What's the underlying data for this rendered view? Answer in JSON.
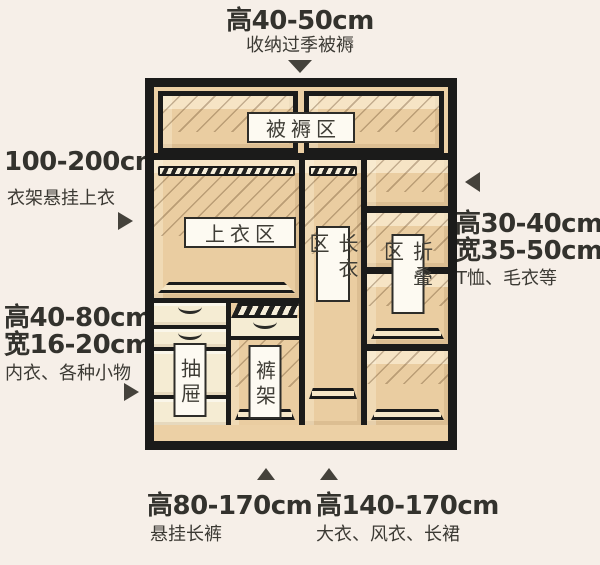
{
  "canvas": {
    "background": "#f6efe8",
    "line_color": "#1b1b1a",
    "wood_color": "#ecd0a5",
    "label_bg": "#fdfaf2",
    "text_color": "#33322d"
  },
  "wardrobe": {
    "labels": {
      "bedding_zone": "被褥区",
      "tops_zone": "上衣区",
      "long_clothes_zone": "长衣区",
      "folding_zone": "折叠区",
      "drawers": "抽屉",
      "pants_rack": "裤架"
    }
  },
  "annotations": {
    "top": {
      "dimension": "高40-50cm",
      "description": "收纳过季被褥"
    },
    "left_upper": {
      "dimension": "100-200cm",
      "description": "衣架悬挂上衣"
    },
    "left_lower": {
      "dimension_height": "高40-80cm",
      "dimension_width": "宽16-20cm",
      "description": "内衣、各种小物"
    },
    "right": {
      "dimension_height": "高30-40cm",
      "dimension_width": "宽35-50cm",
      "description": "T恤、毛衣等"
    },
    "bottom_left": {
      "dimension": "高80-170cm",
      "description": "悬挂长裤"
    },
    "bottom_right": {
      "dimension": "高140-170cm",
      "description": "大衣、风衣、长裙"
    }
  }
}
